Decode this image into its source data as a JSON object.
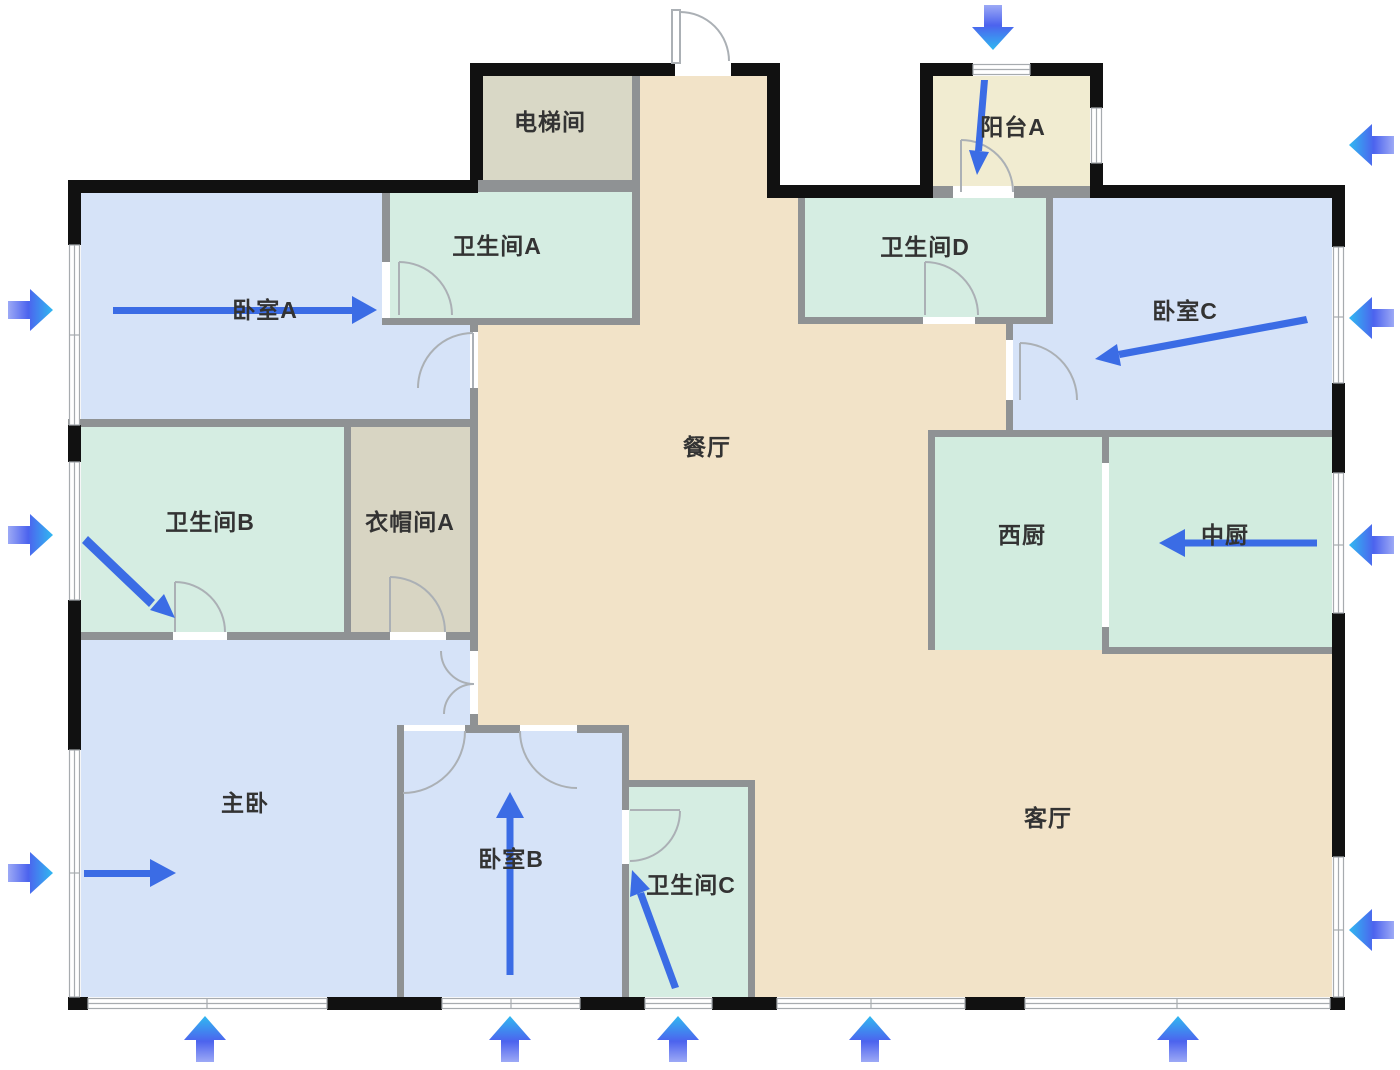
{
  "plan": {
    "type": "apartment-floor-plan",
    "language": "zh-CN",
    "canvas": {
      "width": 1400,
      "height": 1070
    }
  },
  "rooms": {
    "dining": {
      "label": "餐厅"
    },
    "living": {
      "label": "客厅"
    },
    "master": {
      "label": "主卧"
    },
    "bedroomA": {
      "label": "卧室A"
    },
    "bedroomB": {
      "label": "卧室B"
    },
    "bedroomC": {
      "label": "卧室C"
    },
    "bathA": {
      "label": "卫生间A"
    },
    "bathB": {
      "label": "卫生间B"
    },
    "bathC": {
      "label": "卫生间C"
    },
    "bathD": {
      "label": "卫生间D"
    },
    "cloakA": {
      "label": "衣帽间A"
    },
    "elevator": {
      "label": "电梯间"
    },
    "balconyA": {
      "label": "阳台A"
    },
    "kitchenW": {
      "label": "西厨"
    },
    "kitchenC": {
      "label": "中厨"
    }
  },
  "airflow_arrows": {
    "exterior": [
      {
        "side": "left",
        "target": "卧室A",
        "direction": "right"
      },
      {
        "side": "left",
        "target": "卫生间B",
        "direction": "right"
      },
      {
        "side": "left",
        "target": "主卧",
        "direction": "right"
      },
      {
        "side": "top",
        "target": "阳台A",
        "direction": "down"
      },
      {
        "side": "right",
        "target": "阳台A",
        "direction": "left"
      },
      {
        "side": "right",
        "target": "卧室C",
        "direction": "left"
      },
      {
        "side": "right",
        "target": "中厨",
        "direction": "left"
      },
      {
        "side": "right",
        "target": "客厅",
        "direction": "left"
      },
      {
        "side": "bottom",
        "target": "主卧",
        "direction": "up"
      },
      {
        "side": "bottom",
        "target": "卧室B",
        "direction": "up"
      },
      {
        "side": "bottom",
        "target": "卫生间C",
        "direction": "up"
      },
      {
        "side": "bottom",
        "target": "客厅",
        "direction": "up"
      },
      {
        "side": "bottom",
        "target": "客厅",
        "direction": "up"
      }
    ],
    "interior": [
      {
        "room": "卧室A",
        "direction": "right"
      },
      {
        "room": "卫生间B",
        "direction": "down-right"
      },
      {
        "room": "主卧",
        "direction": "right"
      },
      {
        "room": "卧室B",
        "direction": "up"
      },
      {
        "room": "卫生间C",
        "direction": "up-left"
      },
      {
        "room": "阳台A",
        "direction": "down"
      },
      {
        "room": "卧室C",
        "direction": "left"
      },
      {
        "room": "中厨",
        "direction": "left"
      }
    ]
  },
  "colors": {
    "floor_open": "#f2e3c8",
    "bedroom": "#d6e3f8",
    "bathroom": "#d5ede2",
    "kitchen": "#d2ecdf",
    "elevator": "#d9d8c6",
    "cloakroom": "#d8d5c3",
    "balcony": "#f1ecd1",
    "wall_exterior": "#111111",
    "wall_interior": "#8f9294",
    "window_stroke": "#a7abaf",
    "door_stroke": "#abb0b5",
    "arrow_blue": "#3b6ce5",
    "arrow_head_cyan": "#30b9f1",
    "arrow_tail_indigo": "#4c63ee",
    "label_color": "#333333",
    "background": "#ffffff"
  }
}
